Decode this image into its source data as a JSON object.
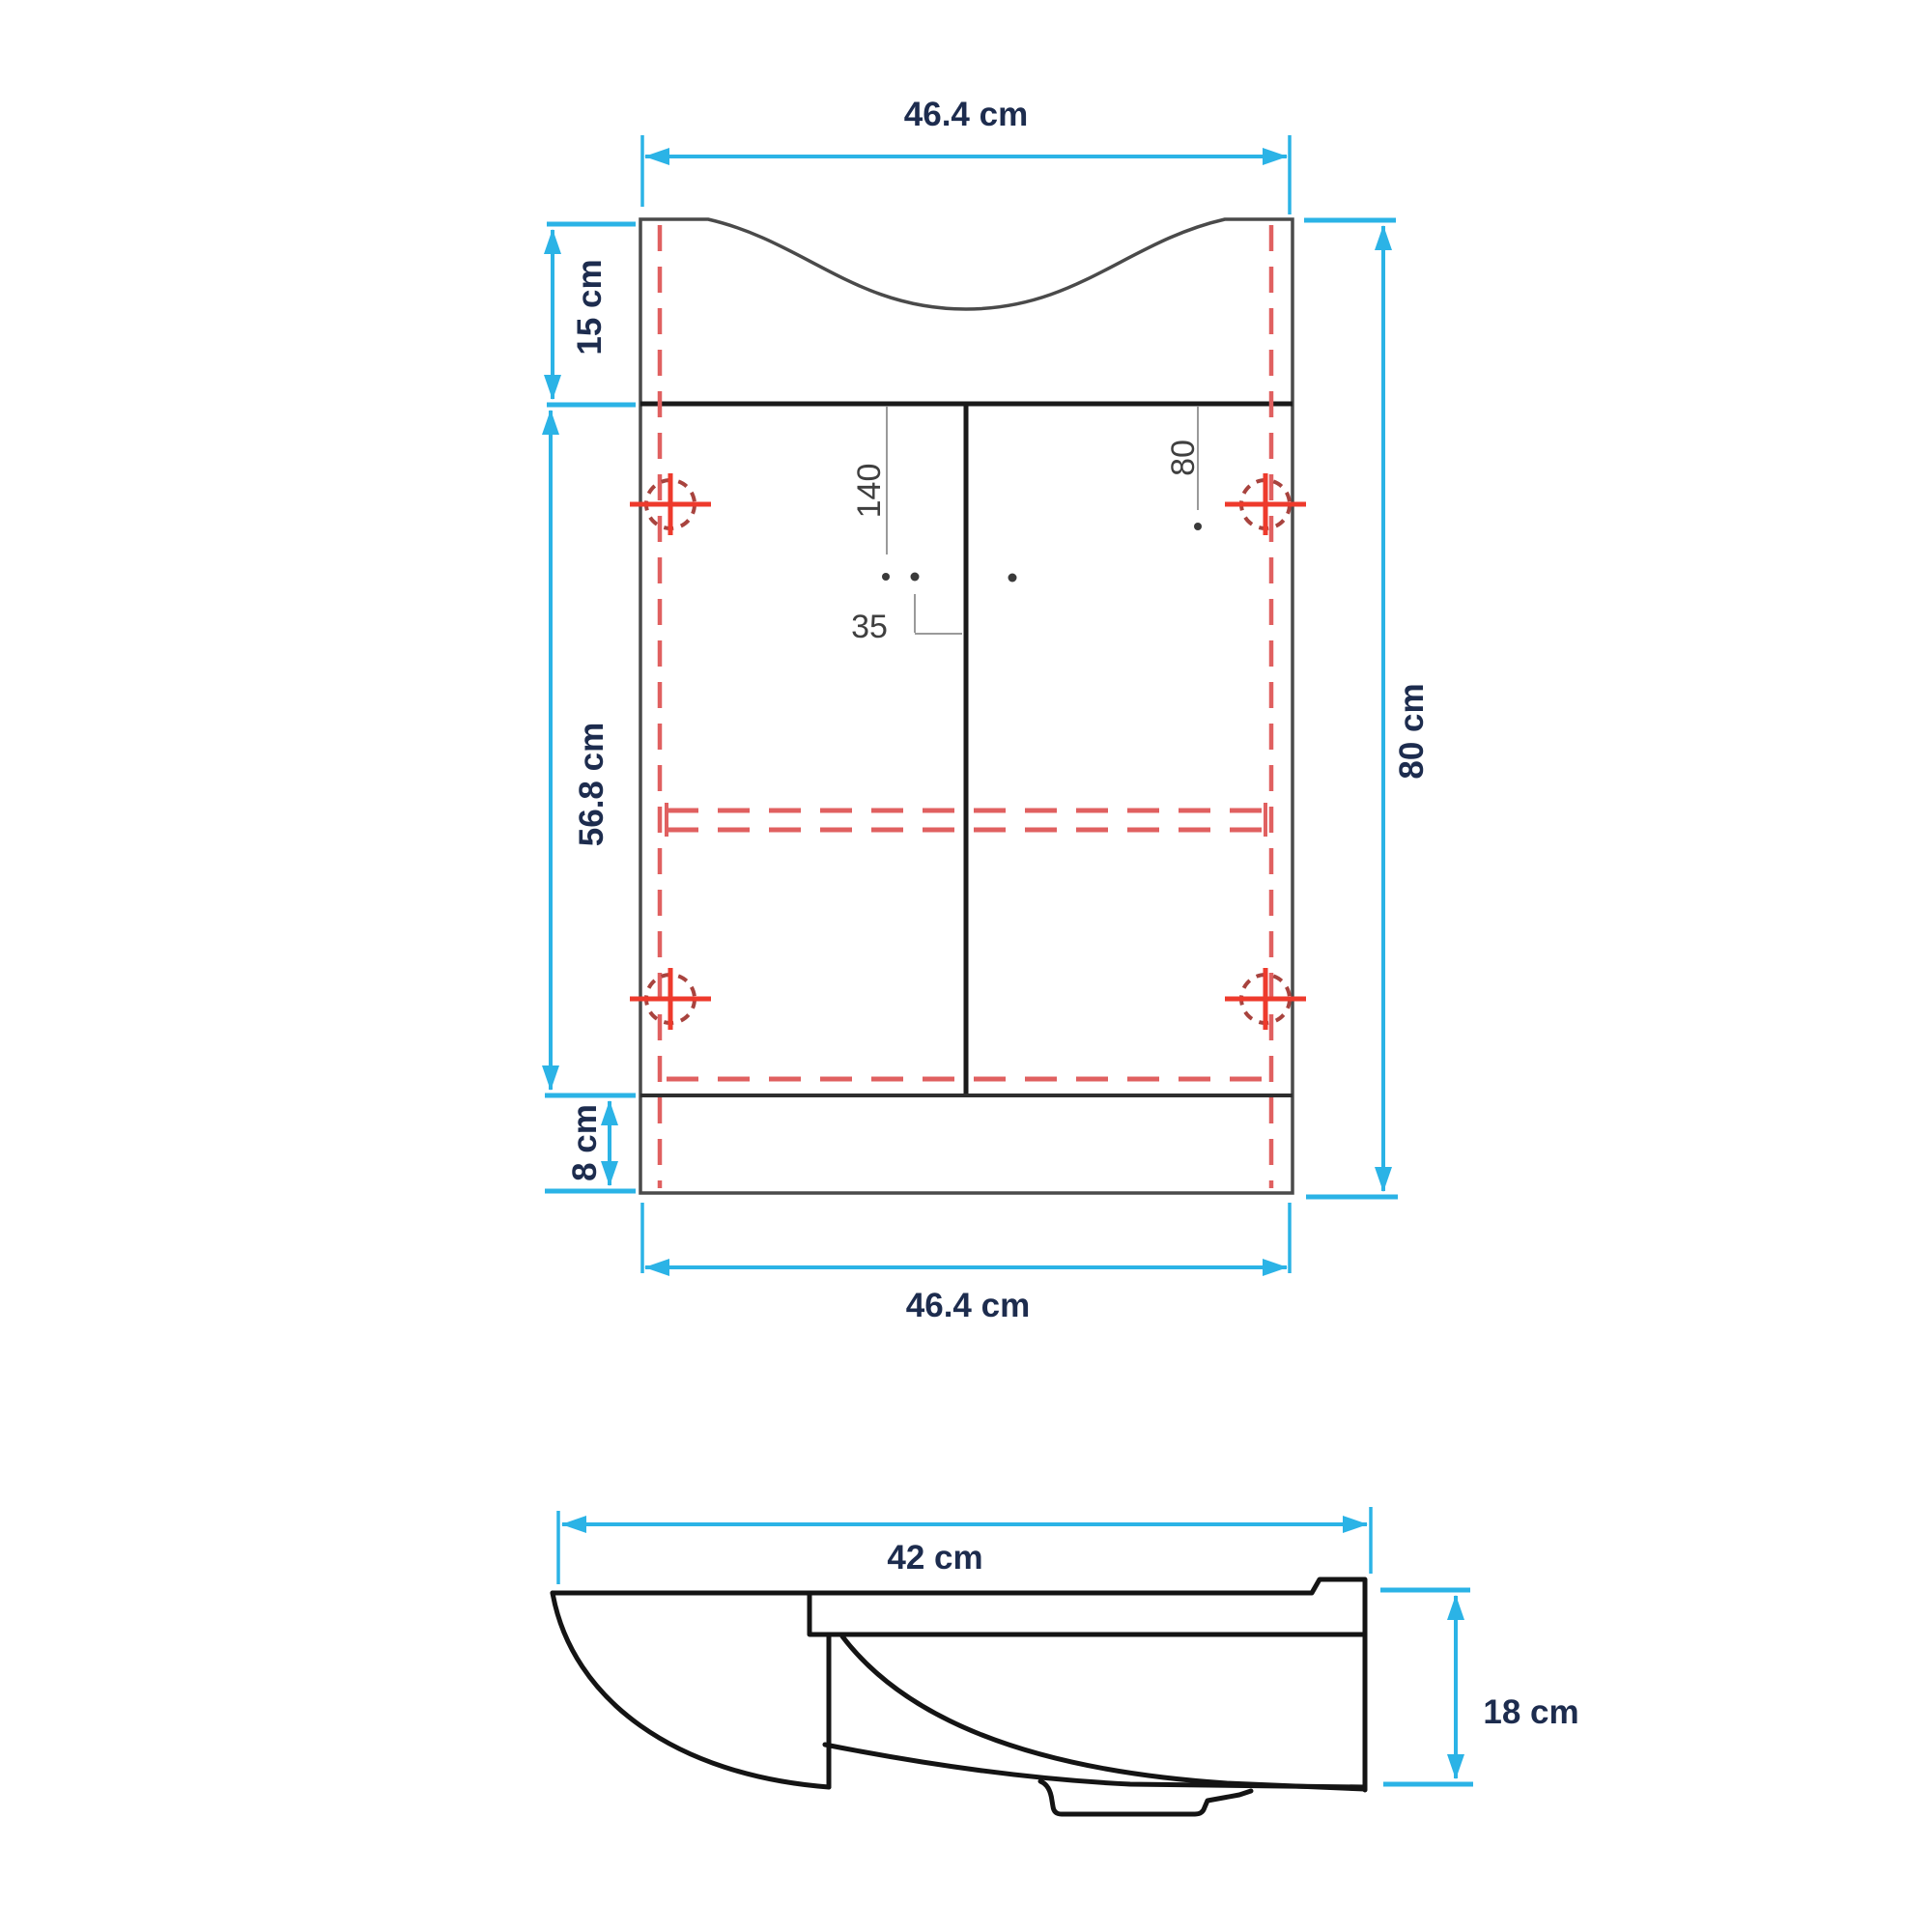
{
  "colors": {
    "background": "#ffffff",
    "dimension": "#2bb3e6",
    "label_text": "#1d2c4e",
    "small_dim_text": "#3f3f3f",
    "outline": "#4a4a4a",
    "heavy_line": "#1a1a1a",
    "hidden_line": "#e06060",
    "hinge_cross": "#ee3a2c",
    "hinge_circle": "#a8433e",
    "leader": "#9a9a9a",
    "profile_line": "#141414"
  },
  "front_view": {
    "dim_top_width": "46.4 cm",
    "dim_basin_height": "15 cm",
    "dim_carcass_height": "56.8 cm",
    "dim_plinth_height": "8 cm",
    "dim_total_height": "80 cm",
    "dim_bottom_width": "46.4 cm",
    "dim_handle_drop_mm": "140",
    "dim_handle_spacing_mm": "35",
    "dim_hinge_offset_mm": "80"
  },
  "side_view": {
    "dim_depth": "42 cm",
    "dim_basin_front_height": "18 cm"
  }
}
